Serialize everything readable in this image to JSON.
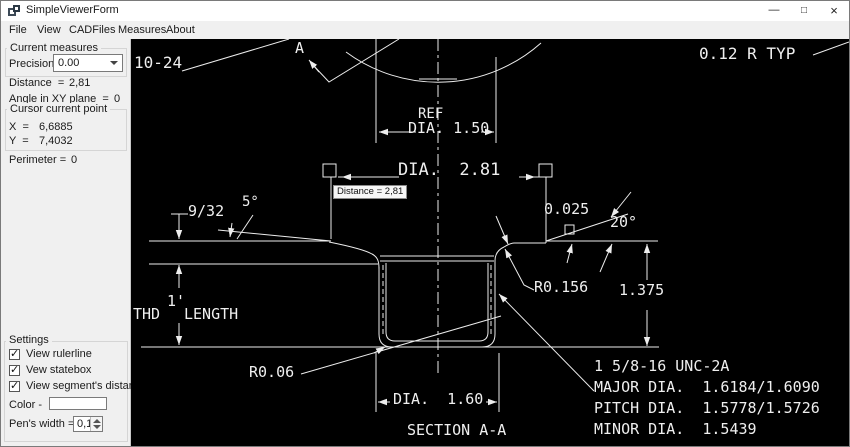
{
  "window": {
    "title": "SimpleViewerForm",
    "controls": {
      "minimize": "—",
      "maximize": "□",
      "close": "×"
    }
  },
  "menu": {
    "items": [
      "File",
      "View",
      "CADFiles",
      "Measures",
      "About"
    ]
  },
  "panel": {
    "current_measures": {
      "group_label": "Current measures",
      "precision_label": "Precision =",
      "precision_value": "0.00",
      "distance_label": "Distance  =",
      "distance_value": "2,81",
      "angle_label": "Angle in XY plane  =",
      "angle_value": "0"
    },
    "cursor_point": {
      "group_label": "Cursor current point",
      "x_label": "X  =",
      "x_value": "6,6885",
      "y_label": "Y  =",
      "y_value": "7,4032"
    },
    "perimeter_label": "Perimeter =",
    "perimeter_value": "0",
    "settings": {
      "group_label": "Settings",
      "check_glyph": "✓",
      "checkboxes": [
        {
          "label": "View rulerline",
          "checked": true
        },
        {
          "label": "Vew statebox",
          "checked": true
        },
        {
          "label": "View segment's distance",
          "checked": true
        }
      ],
      "color_label": "Color -",
      "pen_width_label": "Pen's width =",
      "pen_width_value": "0,1"
    }
  },
  "drawing": {
    "tooltip": "Distance = 2,81",
    "labels": {
      "a_marker": "A",
      "thread_callout": "10-24",
      "radius_typ": "0.12 R TYP",
      "ref": "REF",
      "ref_dia": "DIA. 1.50",
      "dia_281": "DIA.  2.81",
      "dim_9_32": "9/32",
      "angle_5": "5°",
      "dim_0025": "0.025",
      "angle_20": "20°",
      "r_0156": "R0.156",
      "dim_1375": "1.375",
      "thd_1": "1'",
      "thd_word": "THD",
      "length_word": "LENGTH",
      "r_006": "R0.06",
      "dia_160": "DIA.  1.60",
      "section": "SECTION A-A",
      "note_line1": "1 5/8-16 UNC-2A",
      "note_line2": "MAJOR DIA.  1.6184/1.6090",
      "note_line3": "PITCH DIA.  1.5778/1.5726",
      "note_line4": "MINOR DIA.  1.5439"
    }
  }
}
